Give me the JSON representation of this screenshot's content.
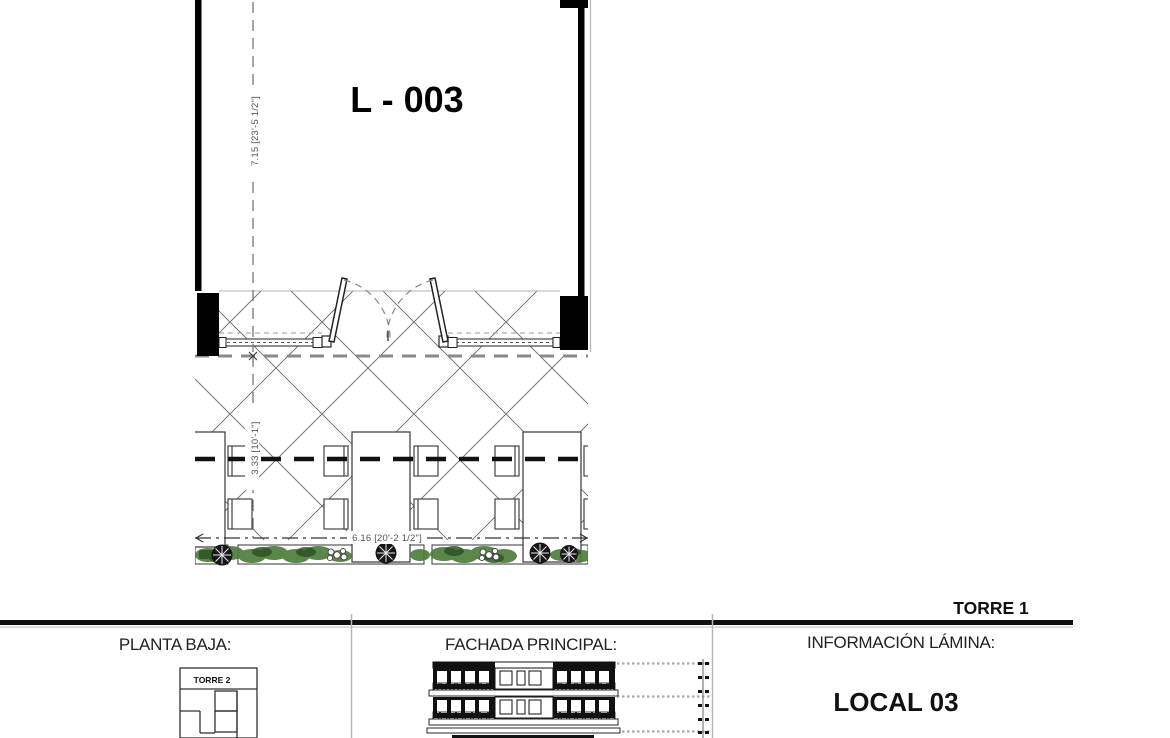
{
  "plan": {
    "room_label": "L - 003",
    "dims": {
      "depth": "7.15 [23'-5 1/2\"]",
      "terrace_depth": "3.33 [10'-1\"]",
      "width": "6.16 [20'-2 1/2\"]"
    }
  },
  "title_block": {
    "tower": "TORRE 1",
    "sections": [
      {
        "heading": "PLANTA BAJA:",
        "mini_plan_label": "TORRE 2"
      },
      {
        "heading": "FACHADA PRINCIPAL:"
      },
      {
        "heading": "INFORMACIÓN LÁMINA:",
        "local_label": "LOCAL 03"
      }
    ]
  },
  "colors": {
    "line": "#111111",
    "hatch": "#666666",
    "dim_text": "#555555",
    "plant_green": "#4e7d3c",
    "divider": "#b8b8b8"
  }
}
